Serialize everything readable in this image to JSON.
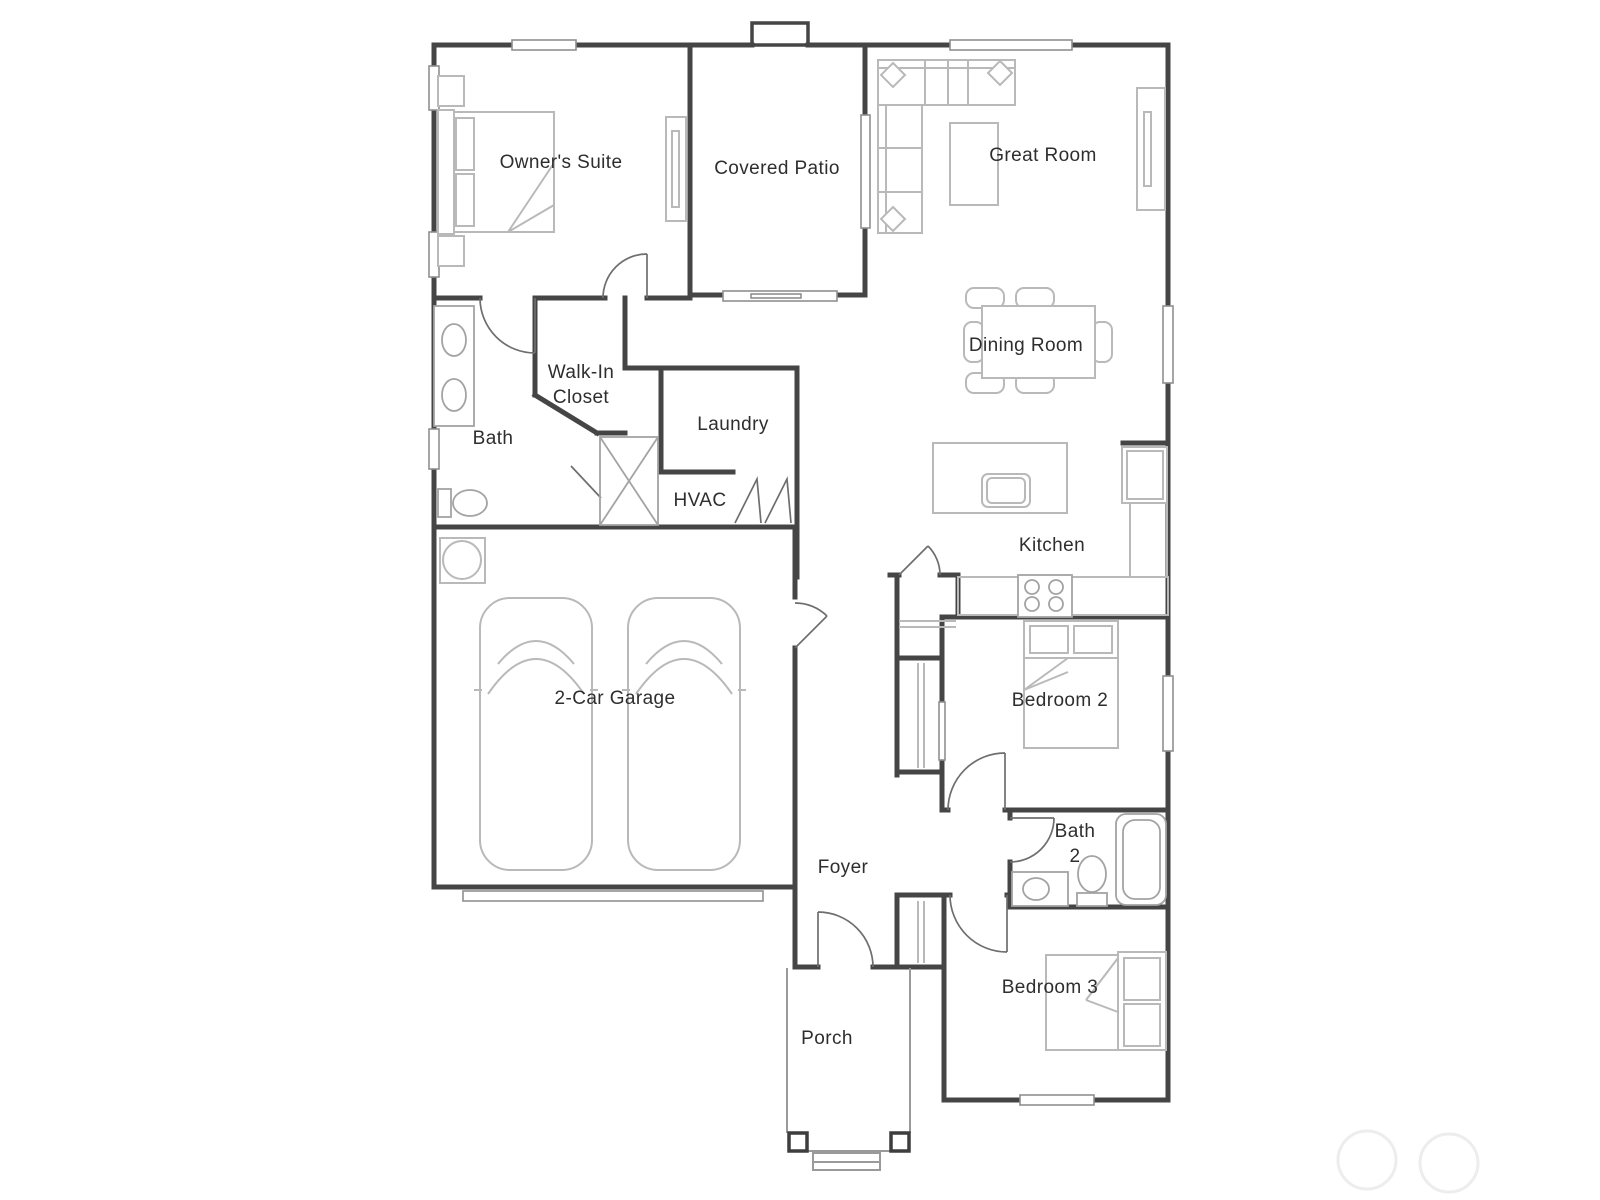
{
  "floorplan": {
    "title": "Single-story home floor plan",
    "rooms": {
      "owners_suite": {
        "label": "Owner's Suite"
      },
      "covered_patio": {
        "label": "Covered Patio"
      },
      "great_room": {
        "label": "Great Room"
      },
      "dining_room": {
        "label": "Dining Room"
      },
      "walk_in_closet": {
        "label_line1": "Walk-In",
        "label_line2": "Closet"
      },
      "laundry": {
        "label": "Laundry"
      },
      "bath": {
        "label": "Bath"
      },
      "hvac": {
        "label": "HVAC"
      },
      "kitchen": {
        "label": "Kitchen"
      },
      "garage": {
        "label": "2-Car Garage"
      },
      "bedroom2": {
        "label": "Bedroom 2"
      },
      "bath2": {
        "label_line1": "Bath",
        "label_line2": "2"
      },
      "foyer": {
        "label": "Foyer"
      },
      "bedroom3": {
        "label": "Bedroom 3"
      },
      "porch": {
        "label": "Porch"
      }
    },
    "colors": {
      "wall": "#454545",
      "furniture": "#b9b9b9",
      "fixture": "#a3a3a3",
      "door": "#6e6e6e",
      "winstroke": "#8f8f8f",
      "label": "#2e2e2e",
      "watermark": "#ededed",
      "background": "#ffffff"
    }
  }
}
